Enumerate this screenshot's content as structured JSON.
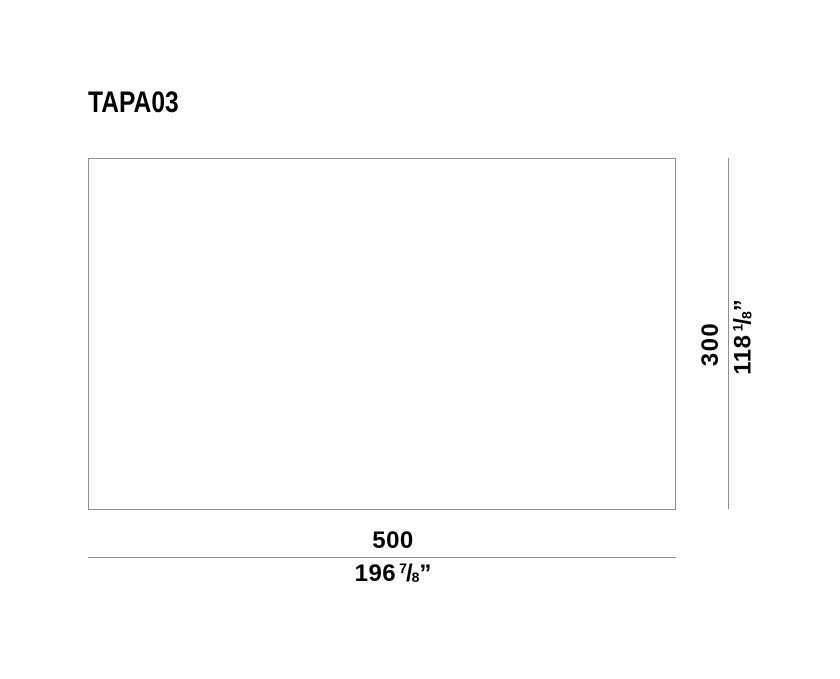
{
  "product": {
    "title": "TAPA03"
  },
  "dimensions": {
    "width": {
      "mm": "500",
      "inches": {
        "whole": "196",
        "numerator": "7",
        "denominator": "8",
        "unit": "”"
      }
    },
    "height": {
      "mm": "300",
      "inches": {
        "whole": "118",
        "numerator": "1",
        "denominator": "8",
        "unit": "”"
      }
    }
  },
  "style": {
    "line_color": "#8f8f8f",
    "text_color": "#000000",
    "background": "#ffffff"
  }
}
